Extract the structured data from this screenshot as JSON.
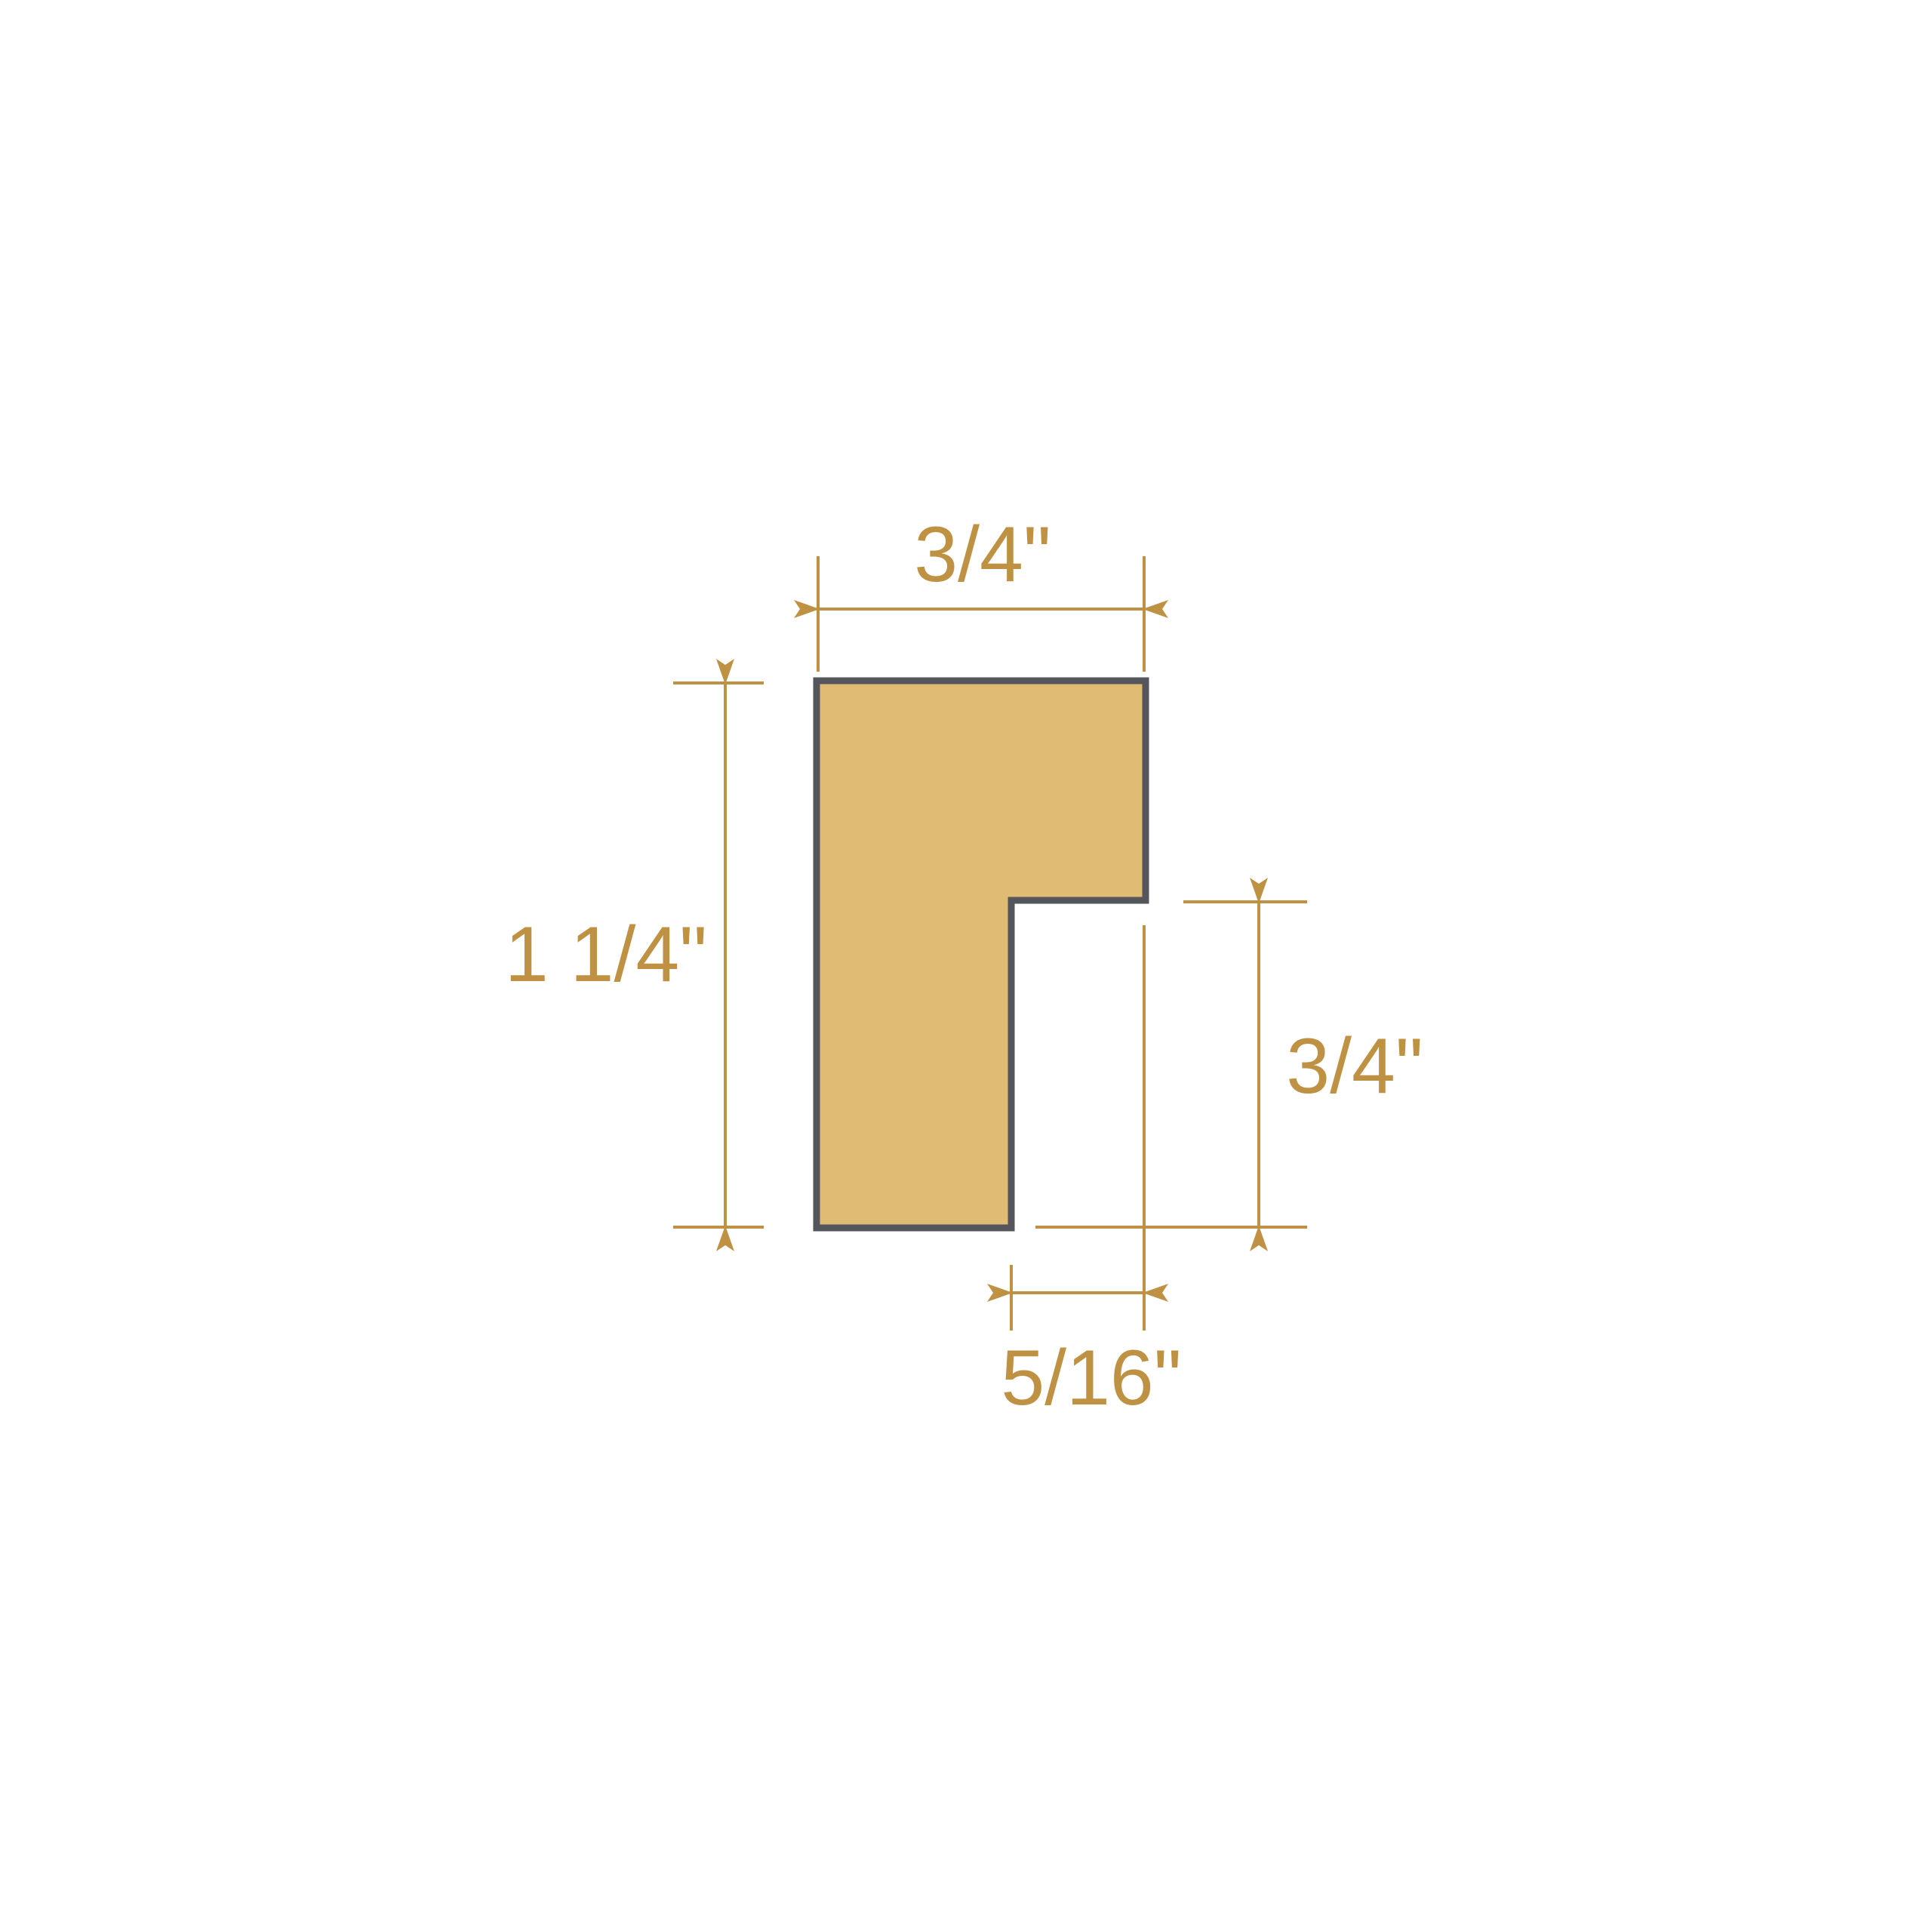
{
  "diagram": {
    "kind": "moulding-profile-cross-section",
    "colors": {
      "profile_fill": "#e0bb74",
      "profile_outline": "#54565b",
      "dimension": "#be9143",
      "background": "#ffffff"
    },
    "dimensions": {
      "top_width": {
        "label": "3/4\""
      },
      "left_height": {
        "label": "1 1/4\""
      },
      "right_height": {
        "label": "3/4\""
      },
      "bottom_width": {
        "label": "5/16\""
      }
    }
  }
}
